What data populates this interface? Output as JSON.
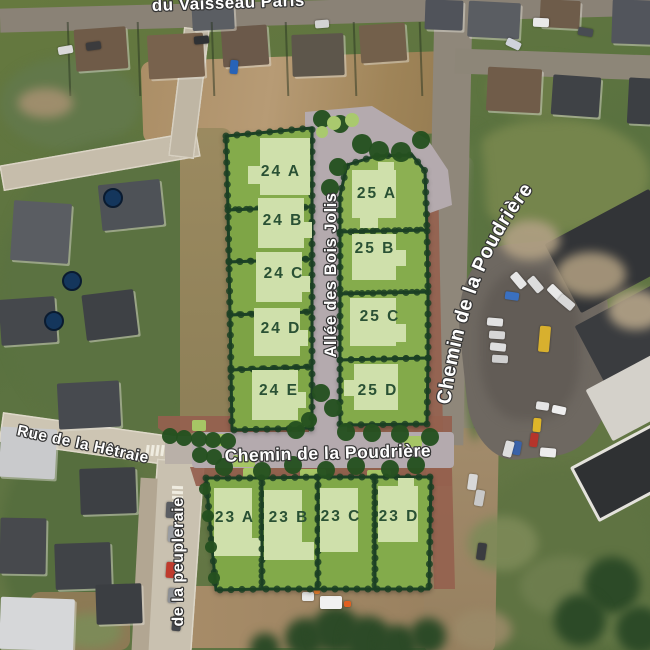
{
  "map": {
    "streets": {
      "top": "du Vaisseau Paris",
      "right_diagonal": "Chemin de la Poudrière",
      "central": "Chemin de la Poudrière",
      "vertical": "Allée des Bois Jolis",
      "left": "Rue de la Hêtraie",
      "bottom_left_vertical": "de la peupleraie"
    },
    "blocks": [
      {
        "id": "24",
        "lots": [
          "24 A",
          "24 B",
          "24 C",
          "24 D",
          "24 E"
        ]
      },
      {
        "id": "25",
        "lots": [
          "25 A",
          "25 B",
          "25 C",
          "25 D"
        ]
      },
      {
        "id": "23",
        "lots": [
          "23 A",
          "23 B",
          "23 C",
          "23 D"
        ]
      }
    ],
    "colors": {
      "lot_fill": "#82a94a",
      "house_footprint": "#cfe0ab",
      "lot_border": "#1c4126",
      "new_road": "#b4aaae",
      "brick_path": "#95604e",
      "tree": "#24501f",
      "lot_label_text": "#2a5134",
      "street_label_text": "#ffffff"
    }
  }
}
